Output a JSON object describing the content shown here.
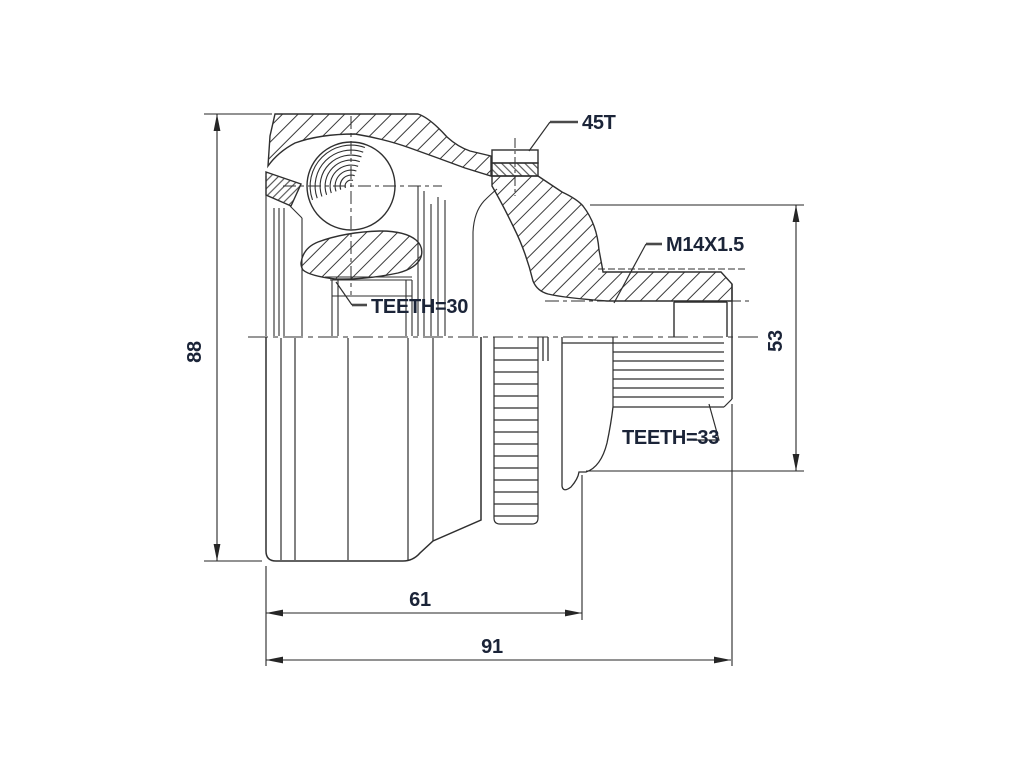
{
  "drawing": {
    "annotations": {
      "sensor_ring_teeth": "45T",
      "thread_spec": "M14X1.5",
      "inner_race_spline": "TEETH=30",
      "outer_spline": "TEETH=33"
    },
    "dimensions": {
      "outer_diameter_mm": "88",
      "body_length_mm": "61",
      "total_length_mm": "91",
      "flange_diameter_mm": "53"
    },
    "colors": {
      "line": "#2f2f2f",
      "text": "#1b2438",
      "background": "#ffffff"
    }
  }
}
